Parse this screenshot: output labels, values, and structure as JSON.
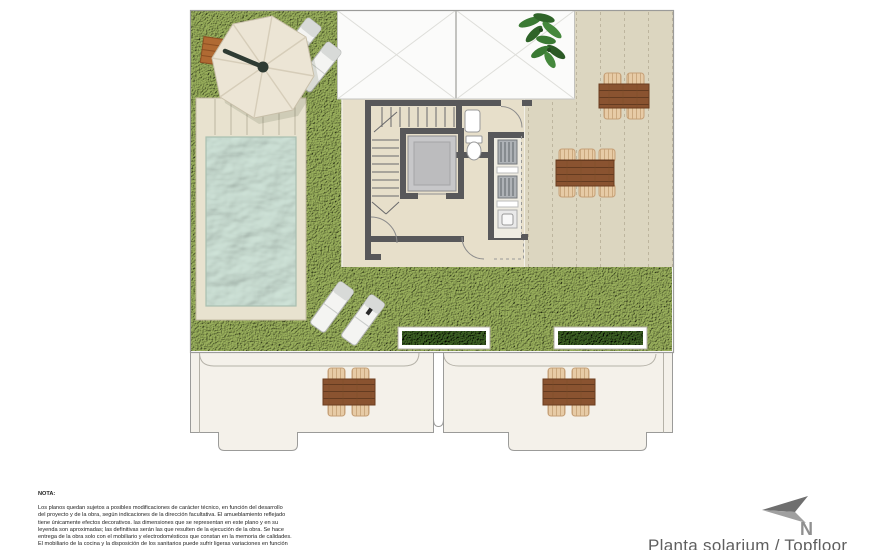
{
  "title": {
    "text": "Planta solarium / Topfloor"
  },
  "compass": {
    "label": "N"
  },
  "note": {
    "heading": "NOTA:",
    "lines": [
      "Los planos quedan sujetos a posibles modificaciones de carácter técnico, en función del desarrollo",
      "del proyecto y de la obra, según indicaciones de la dirección facultativa. El amueblamiento reflejado",
      "tiene únicamente efectos decorativos. las dimensiones que se representan en este plano y en su",
      "leyenda son aproximadas; las definitivas serán las que resulten de la ejecución de la obra. Se hace",
      "entrega de la obra solo con el mobiliario y electrodomésticos que constan en la memoria de calidades.",
      "El mobiliario de la cocina y la disposición de los sanitarios puede sufrir ligeras variaciones en función"
    ]
  },
  "plan": {
    "colors": {
      "grass": "#8ba351",
      "grass_light": "#9db45e",
      "terrace_tile": "#dcd6c0",
      "interior_floor": "#e7dfca",
      "pool_water": "#b7d6c9",
      "pool_deck": "#e8e2cf",
      "wall": "#58585a",
      "wood_table": "#8a5330",
      "chair": "#e7cba6",
      "hedge": "#2c471c",
      "umbrella": "#ece5d5",
      "lounger": "#f4f4f2",
      "skylight": "#fbfbfa",
      "plan_border": "#9b9b99",
      "title_text": "#5f5f5f",
      "compass_gray": "#8f8f8f"
    },
    "elements": [
      "grass-lawn",
      "swimming-pool",
      "pool-deck-steps",
      "parasol",
      "wood-bench",
      "sun-loungers",
      "skylights",
      "staircase",
      "elevator",
      "toilet",
      "washbasin",
      "outdoor-kitchen",
      "dining-table-4-seats",
      "dining-table-6-seats",
      "hedge-planters",
      "potted-plant",
      "lower-terraces"
    ]
  }
}
